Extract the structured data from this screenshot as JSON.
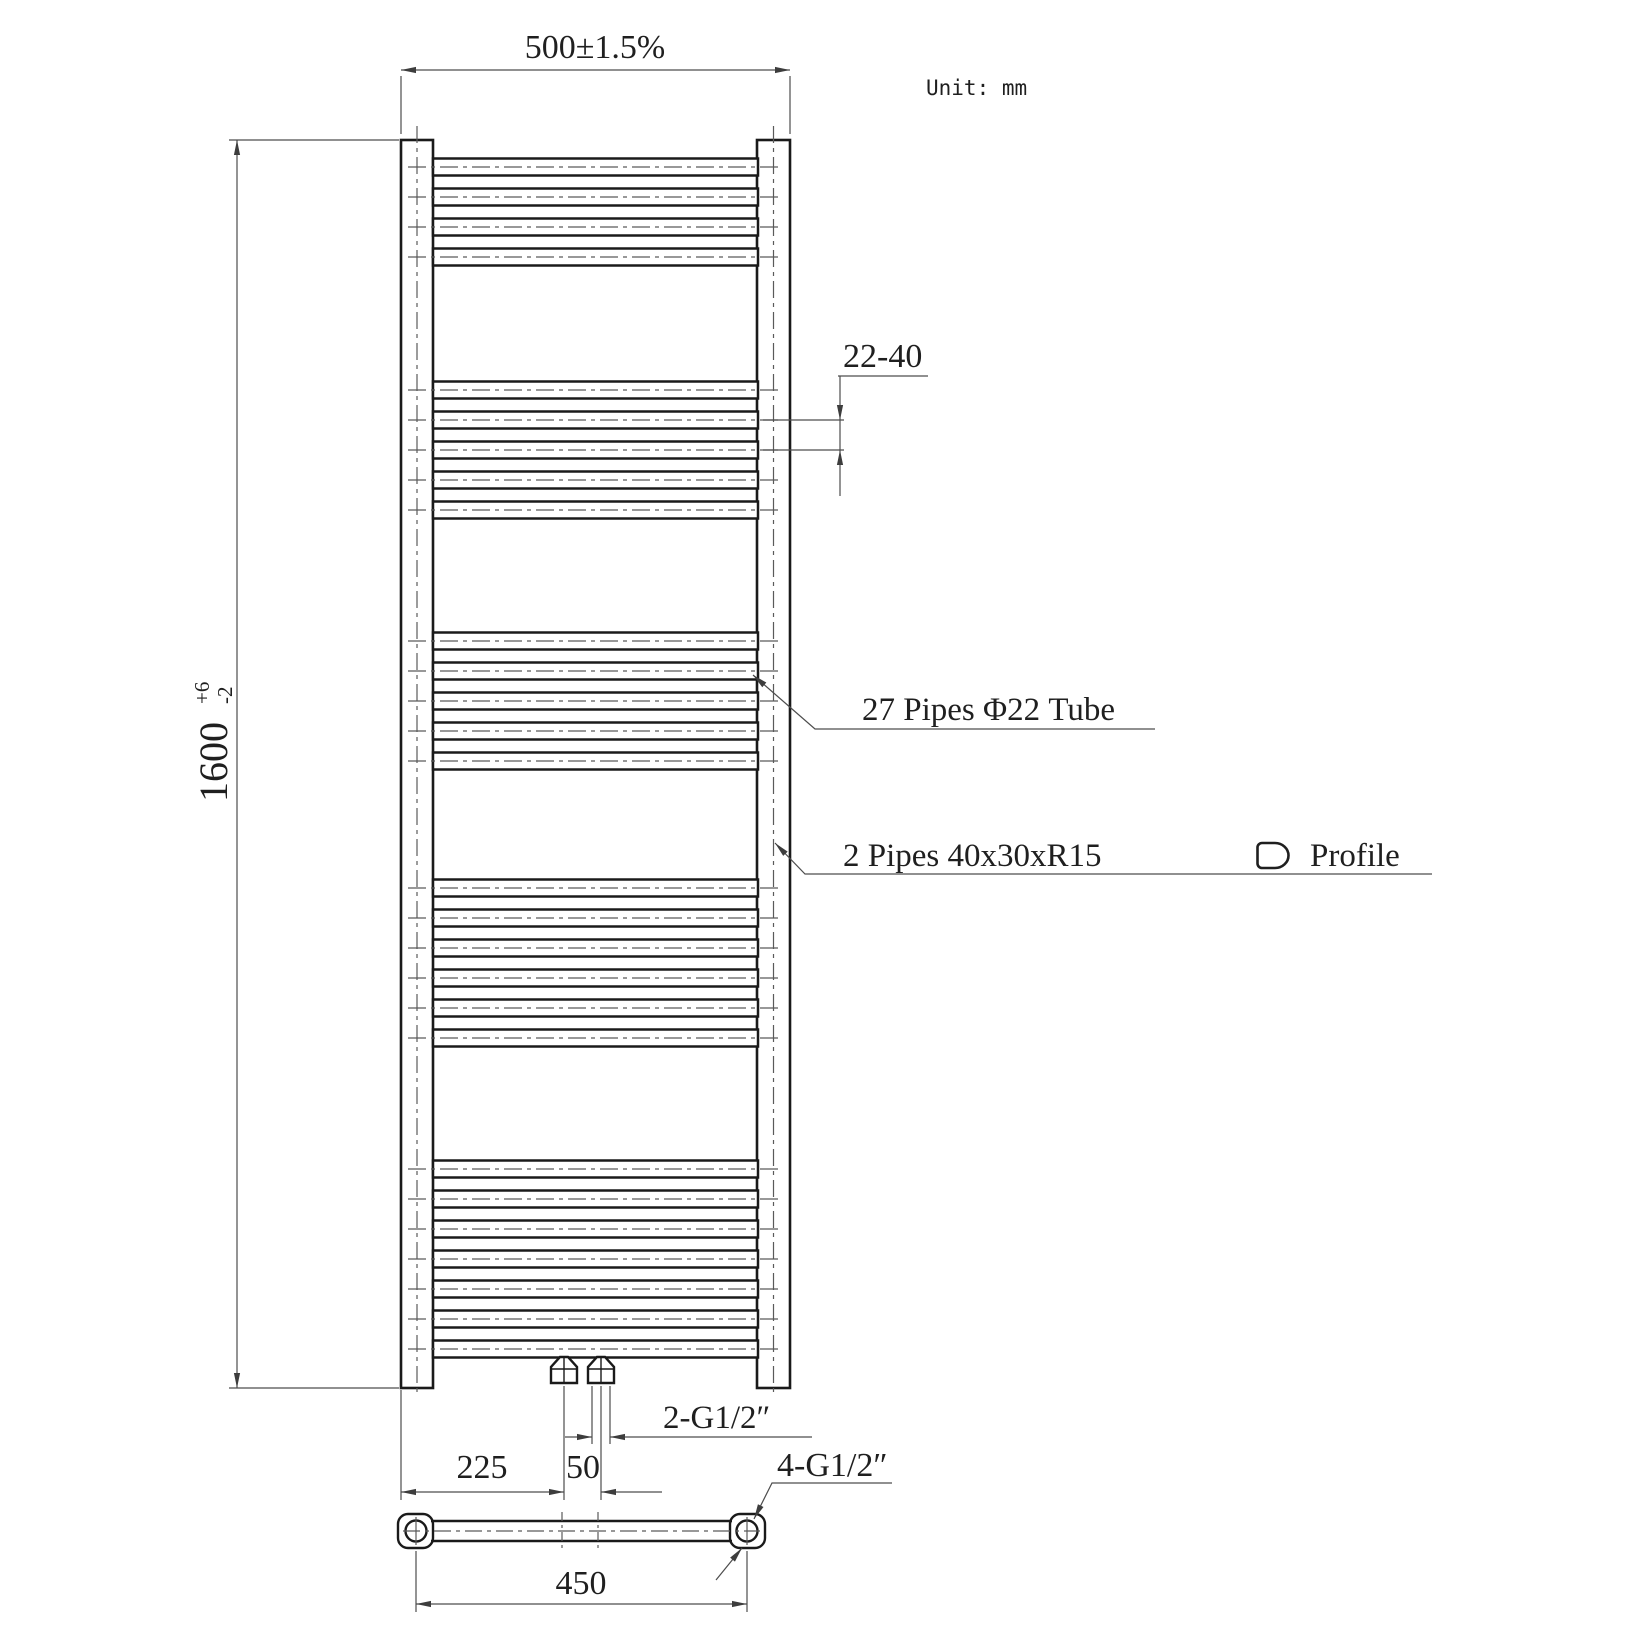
{
  "sheet": {
    "unit_note": "Unit: mm",
    "type_note": "towel-radiator technical drawing, front view and bottom view"
  },
  "labels": {
    "width_dim": "500±1.5%",
    "height_dim_value": "1600",
    "height_tol_plus": "+6",
    "height_tol_minus": "-2",
    "pipe_gap_dim": "22-40",
    "pipes_note": "27 Pipes Φ22 Tube",
    "rails_note": "2 Pipes 40x30xR15",
    "profile_label": "Profile",
    "offset_dim": "225",
    "valve_spacing_dim": "50",
    "bottom_connections_note": "2-G1/2″",
    "side_connections_note": "4-G1/2″",
    "hole_centers_dim": "450"
  },
  "drawing": {
    "pipe_count": 27,
    "pipe_pitch_px": 30,
    "pipe_height_px": 17,
    "pipe_x1": 433,
    "pipe_x2": 758,
    "centerline_x1": 408,
    "centerline_x2": 783,
    "pipe_groups": [
      {
        "count": 4,
        "start_y": 167
      },
      {
        "count": 5,
        "start_y": 390
      },
      {
        "count": 5,
        "start_y": 641
      },
      {
        "count": 6,
        "start_y": 888
      },
      {
        "count": 7,
        "start_y": 1169
      }
    ]
  },
  "colors": {
    "object_line": "#1a1a1a",
    "dim_line": "#4d4d4d",
    "centerline": "#5a5a5a",
    "background": "#ffffff"
  }
}
